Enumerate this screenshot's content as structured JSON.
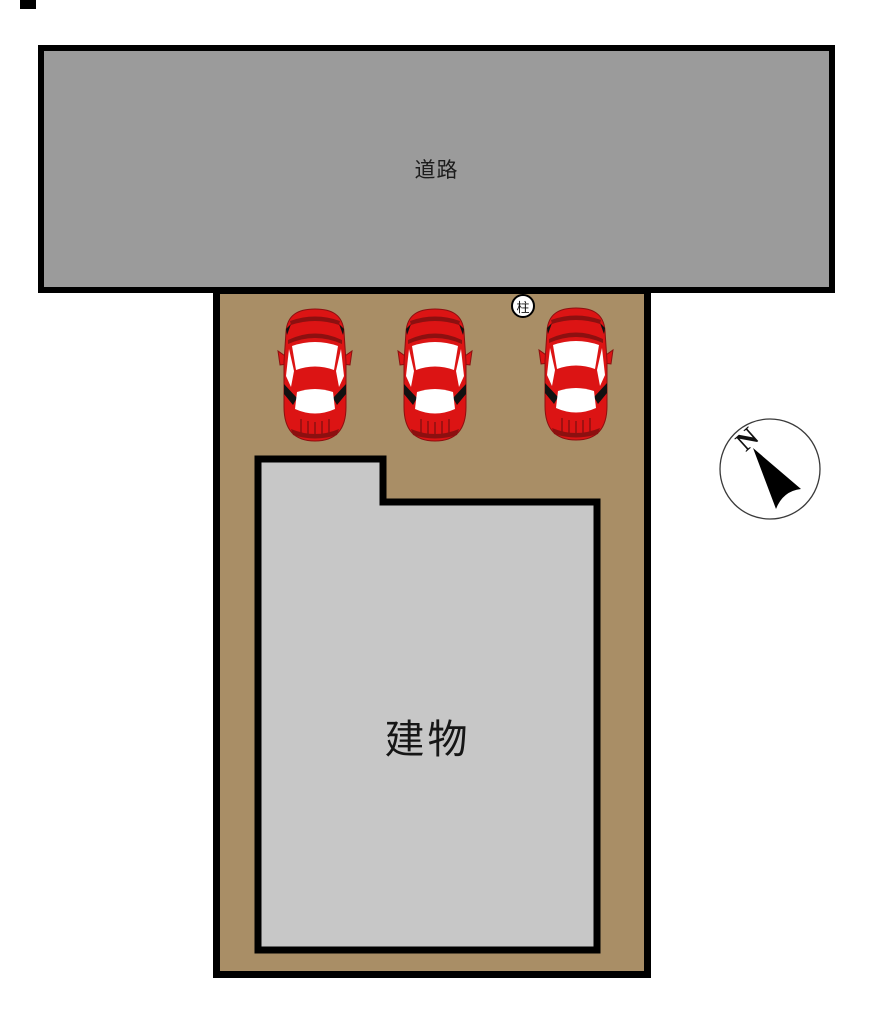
{
  "site_plan": {
    "road": {
      "label": "道路"
    },
    "building": {
      "label": "建物"
    },
    "pillar_marker": {
      "label": "柱"
    },
    "compass": {
      "north_label": "N"
    },
    "cars": {
      "count": 3,
      "icon": "car-top-view-icon"
    }
  },
  "colors": {
    "page_bg": "#ffffff",
    "road_fill": "#9b9b9b",
    "lot_fill": "#a98e66",
    "building_fill": "#c7c7c7",
    "outline": "#000000",
    "car_red": "#dc1414",
    "car_dark_red": "#8c1010",
    "car_detail_black": "#111111",
    "car_window": "#ffffff",
    "compass_ring": "#3a3a3a",
    "needle_fill": "#000000"
  }
}
